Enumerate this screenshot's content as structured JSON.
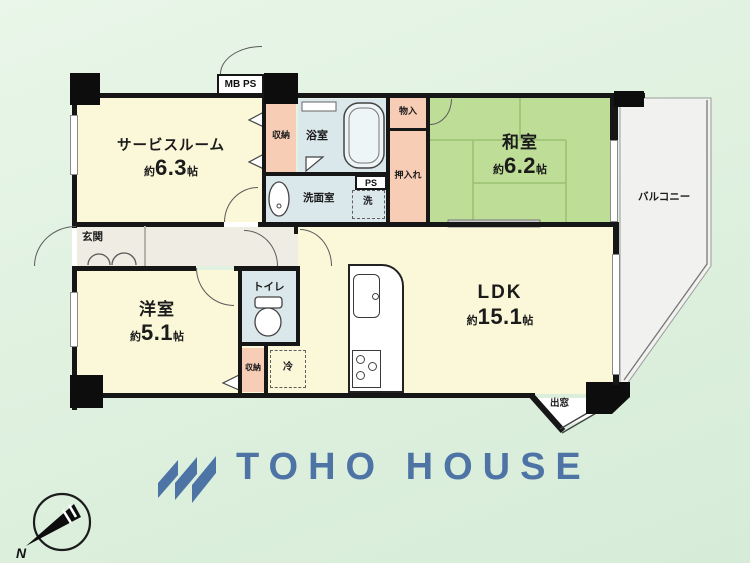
{
  "plan": {
    "rooms": {
      "service_room": {
        "label": "サービスルーム",
        "area_prefix": "約",
        "area_value": "6.3",
        "area_suffix": "帖"
      },
      "washitsu": {
        "label": "和室",
        "area_prefix": "約",
        "area_value": "6.2",
        "area_suffix": "帖"
      },
      "youshitsu": {
        "label": "洋室",
        "area_prefix": "約",
        "area_value": "5.1",
        "area_suffix": "帖"
      },
      "ldk": {
        "label": "LDK",
        "area_prefix": "約",
        "area_value": "15.1",
        "area_suffix": "帖"
      },
      "balcony": {
        "label": "バルコニー"
      },
      "genkan": {
        "label": "玄関"
      },
      "bathroom": {
        "label": "浴室"
      },
      "washroom": {
        "label": "洗面室"
      },
      "toilet": {
        "label": "トイレ"
      }
    },
    "fixtures": {
      "meter_box": "MB PS",
      "pipe_space": "PS",
      "closet_hall": "収納",
      "closet_bedroom": "収納",
      "storage_monoire": "物入",
      "closet_oshiire": "押入れ",
      "washer": "洗",
      "fridge": "冷",
      "bay_window": "出窓"
    },
    "colors": {
      "wall": "#161616",
      "room_cream": "#FBF7D9",
      "closet_salmon": "#F8CDB6",
      "wet_area_blue": "#DAE7EB",
      "tatami_green": "#BEDD97",
      "hall_gray": "#EFEDE3",
      "balcony_gray": "#F1F1EF",
      "background_green": "#E3F2E2"
    }
  },
  "branding": {
    "logo_text": "TOHO HOUSE",
    "logo_color": "#4E74A6"
  },
  "compass": {
    "label": "N"
  }
}
